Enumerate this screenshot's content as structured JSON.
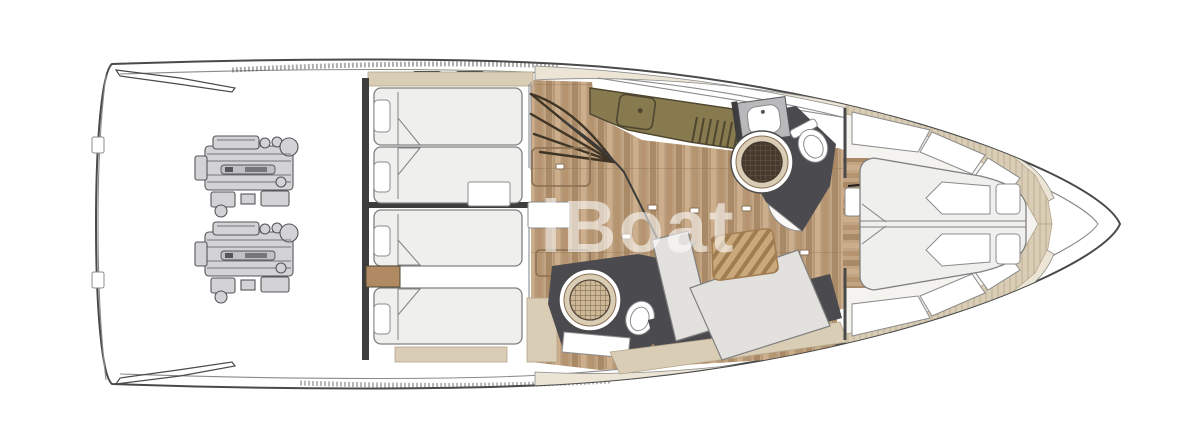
{
  "watermark": {
    "text": "iBoat"
  },
  "colors": {
    "paper": "#ffffff",
    "hull_line": "#4a4a4a",
    "inner_line": "#8b8b8b",
    "wood_base": "#c2a482",
    "wood_dark": "#aa8a66",
    "wood_mid": "#b6946f",
    "wood_light": "#ccae8c",
    "wood_seam": "#8a6f52",
    "tan": "#d9cdb6",
    "tan_line": "#b4a68a",
    "cream": "#ece5d6",
    "charcoal": "#4b4b4f",
    "olive": "#867a4e",
    "olive_dark": "#4f4630",
    "mattress": "#efefed",
    "mattress_line": "#808080",
    "panel_gray": "#e2e1dd",
    "white": "#ffffff",
    "floor_white": "#f4f3ef",
    "dark_wall": "#3d3d3d",
    "engine": "#d3d3d6",
    "engine_line": "#55555a",
    "engine_shade": "#c0c0c5",
    "dresser": "#b08a63",
    "teak": "#c9a97b",
    "teak_stripe": "#a07c50",
    "grate_dark_bg": "#46392d",
    "grate_dark_line": "#6b5c48",
    "grate_light_bg": "#cdb794",
    "grate_light_line": "#57493a",
    "step_line": "#3f3527",
    "cleat": "#1c1c1e",
    "watermark": "rgba(255,255,255,0.58)"
  }
}
